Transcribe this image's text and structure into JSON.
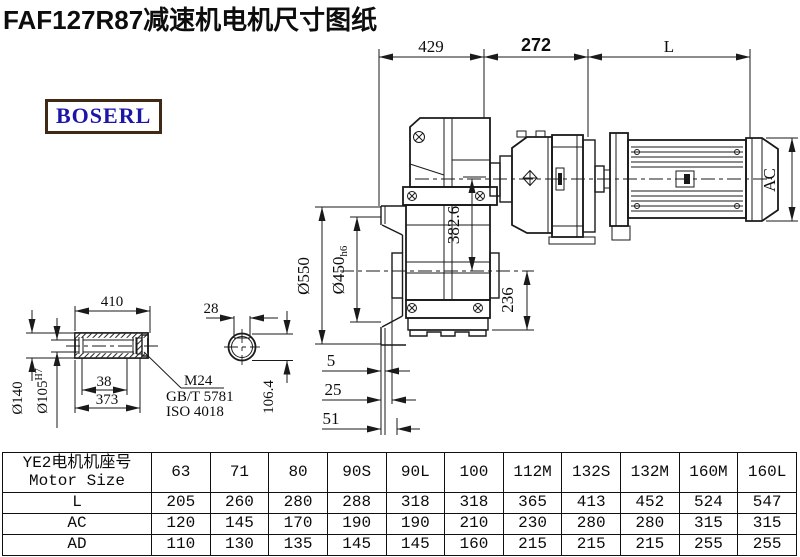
{
  "title": "FAF127R87减速机电机尺寸图纸",
  "logo": {
    "text": "BOSERL"
  },
  "colors": {
    "line": "#1a1a1a",
    "logo_text": "#1b16a8",
    "logo_border": "#402a16"
  },
  "drawing": {
    "dim_429": "429",
    "dim_272": "272",
    "dim_L": "L",
    "dim_AC": "AC",
    "dim_382_6": "382.6",
    "dim_236": "236",
    "dim_550": "Ø550",
    "dim_450_main": "Ø450",
    "dim_450_suffix": "h6",
    "dim_410": "410",
    "dim_28": "28",
    "dim_140": "Ø140",
    "dim_105_main": "Ø105",
    "dim_105_sup": "H7",
    "dim_38": "38",
    "dim_373": "373",
    "dim_5": "5",
    "dim_25": "25",
    "dim_51": "51",
    "dim_106_4": "106.4",
    "note_m24": "M24",
    "note_gbt": "GB/T 5781",
    "note_iso": "ISO 4018"
  },
  "table": {
    "header_cn": "YE2电机机座号",
    "header_en": "Motor Size",
    "columns": [
      "63",
      "71",
      "80",
      "90S",
      "90L",
      "100",
      "112M",
      "132S",
      "132M",
      "160M",
      "160L"
    ],
    "rows": [
      {
        "label": "L",
        "values": [
          "205",
          "260",
          "280",
          "288",
          "318",
          "318",
          "365",
          "413",
          "452",
          "524",
          "547"
        ]
      },
      {
        "label": "AC",
        "values": [
          "120",
          "145",
          "170",
          "190",
          "190",
          "210",
          "230",
          "280",
          "280",
          "315",
          "315"
        ]
      },
      {
        "label": "AD",
        "values": [
          "110",
          "130",
          "135",
          "145",
          "145",
          "160",
          "215",
          "215",
          "215",
          "255",
          "255"
        ]
      }
    ]
  }
}
